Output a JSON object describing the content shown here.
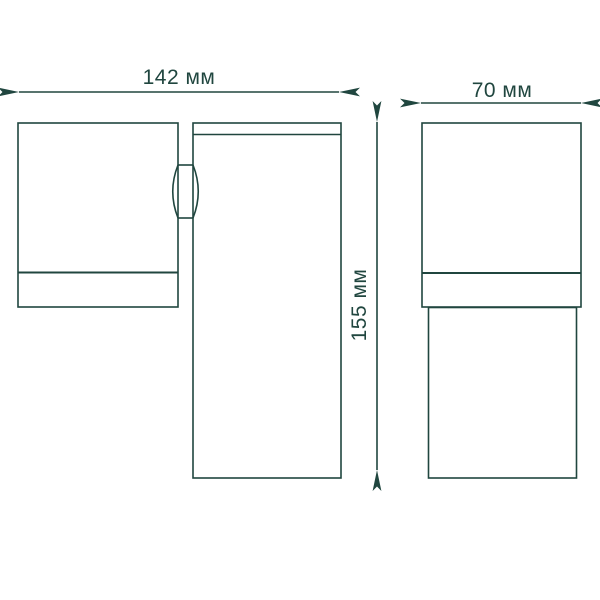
{
  "diagram": {
    "type": "technical-dimension-drawing",
    "subject": "wall-light-fixture",
    "line_color": "#20463f",
    "background_color": "#ffffff",
    "views": {
      "front": {
        "name": "front view",
        "parts": [
          "lamp-head",
          "hinge-joint",
          "body-column"
        ]
      },
      "side": {
        "name": "side view",
        "parts": [
          "head-block",
          "body-column"
        ]
      }
    },
    "dimensions": {
      "front_width": {
        "label": "142 мм",
        "value_mm": 142,
        "orientation": "horizontal"
      },
      "height": {
        "label": "155 мм",
        "value_mm": 155,
        "orientation": "vertical"
      },
      "side_width": {
        "label": "70 мм",
        "value_mm": 70,
        "orientation": "horizontal"
      }
    }
  }
}
